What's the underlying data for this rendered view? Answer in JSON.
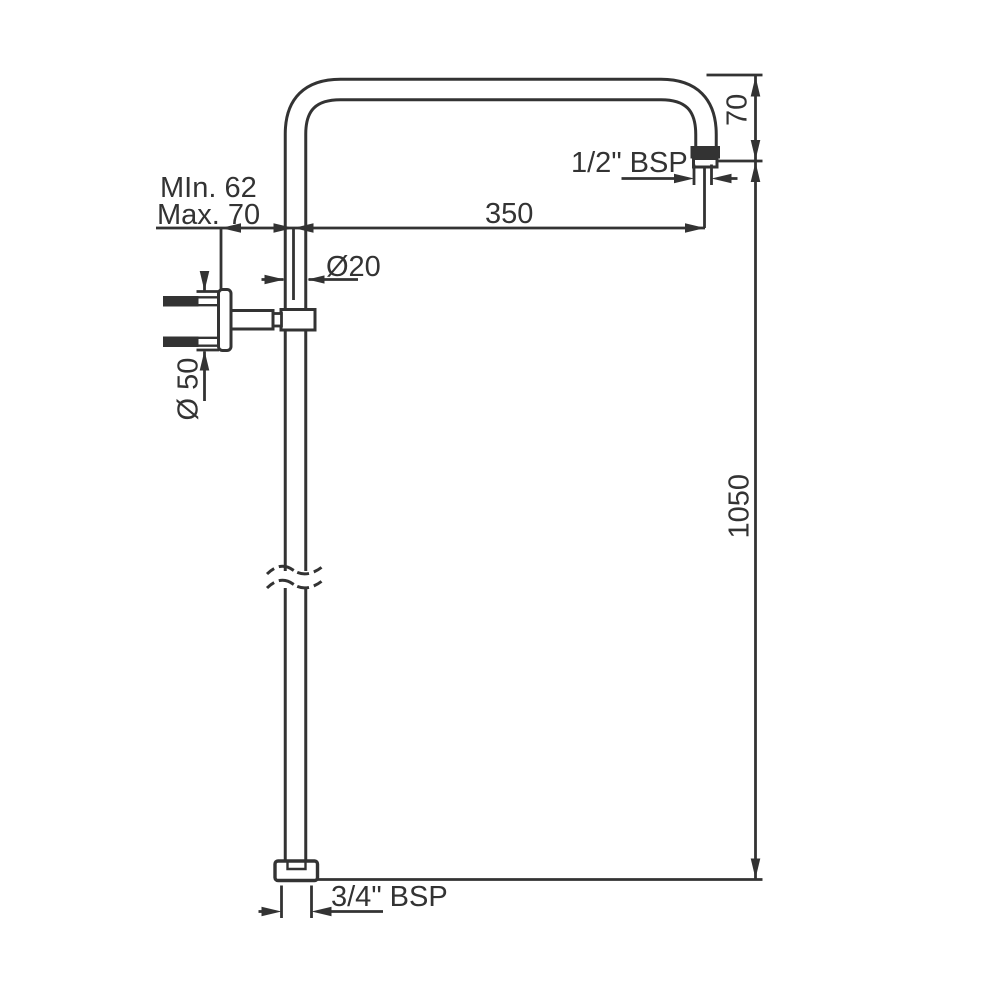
{
  "drawing": {
    "kind": "technical-dimension-drawing",
    "line_color": "#333333",
    "background_color": "#ffffff",
    "labels": {
      "wall_offset_min": "MIn. 62",
      "wall_offset_max": "Max. 70",
      "pipe_diameter": "Ø20",
      "flange_diameter": "Ø 50",
      "arm_length": "350",
      "top_outlet_thread": "1/2\" BSP",
      "arm_drop_height": "70",
      "riser_height": "1050",
      "bottom_inlet_thread": "3/4\" BSP"
    }
  }
}
